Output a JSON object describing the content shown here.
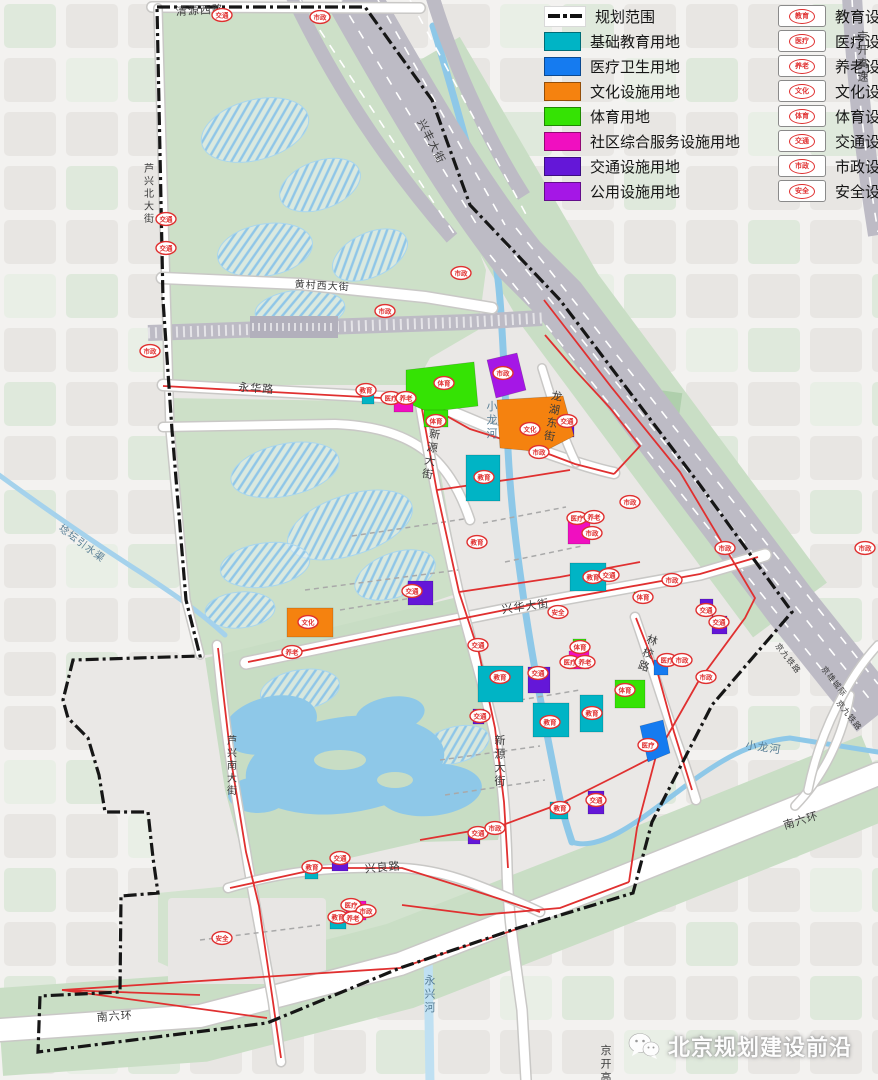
{
  "colors": {
    "education": "#00B4C5",
    "medical": "#157BF0",
    "culture": "#F5820F",
    "sports": "#35E304",
    "community": "#F00FC0",
    "transport": "#6417D8",
    "public": "#A517E6",
    "marker": "#E03030",
    "planning_red": "#E03030",
    "boundary": "#161616",
    "water": "#8EC8E8",
    "park": "#CDE0C8",
    "rail": "#BDBBC5"
  },
  "legend": {
    "land_use": [
      {
        "label": "规划范围",
        "type": "line"
      },
      {
        "label": "基础教育用地",
        "color": "education"
      },
      {
        "label": "医疗卫生用地",
        "color": "medical"
      },
      {
        "label": "文化设施用地",
        "color": "culture"
      },
      {
        "label": "体育用地",
        "color": "sports"
      },
      {
        "label": "社区综合服务设施用地",
        "color": "community"
      },
      {
        "label": "交通设施用地",
        "color": "transport"
      },
      {
        "label": "公用设施用地",
        "color": "public"
      }
    ],
    "facilities": [
      {
        "icon": "教育",
        "label": "教育设施"
      },
      {
        "icon": "医疗",
        "label": "医疗设施"
      },
      {
        "icon": "养老",
        "label": "养老设施"
      },
      {
        "icon": "文化",
        "label": "文化设施"
      },
      {
        "icon": "体育",
        "label": "体育设施"
      },
      {
        "icon": "交通",
        "label": "交通设施"
      },
      {
        "icon": "市政",
        "label": "市政设施"
      },
      {
        "icon": "安全",
        "label": "安全设施"
      }
    ]
  },
  "road_labels": [
    {
      "text": "清源西路",
      "x": 200,
      "y": 14,
      "rotate": -3
    },
    {
      "text": "芦兴北大街",
      "x": 149,
      "y": 172,
      "vertical": true
    },
    {
      "text": "黄村西大街",
      "x": 322,
      "y": 289,
      "rotate": 3
    },
    {
      "text": "永华路",
      "x": 256,
      "y": 392,
      "rotate": 4
    },
    {
      "text": "兴丰大街",
      "x": 428,
      "y": 143,
      "rotate": 63
    },
    {
      "text": "新源大街",
      "x": 434,
      "y": 438,
      "vertical": true,
      "rotate": 10
    },
    {
      "text": "新源大街",
      "x": 500,
      "y": 744,
      "vertical": true
    },
    {
      "text": "兴华大街",
      "x": 526,
      "y": 610,
      "rotate": -8
    },
    {
      "text": "林校路",
      "x": 651,
      "y": 644,
      "vertical": true,
      "rotate": 18
    },
    {
      "text": "龙湖东街",
      "x": 556,
      "y": 400,
      "vertical": true,
      "rotate": 10
    },
    {
      "text": "芦兴南大街",
      "x": 232,
      "y": 744,
      "vertical": true
    },
    {
      "text": "兴良路",
      "x": 383,
      "y": 871,
      "rotate": -5
    },
    {
      "text": "南六环",
      "x": 115,
      "y": 1020,
      "rotate": -4
    },
    {
      "text": "南六环",
      "x": 802,
      "y": 824,
      "rotate": -17
    },
    {
      "text": "京开高速",
      "x": 863,
      "y": 40,
      "vertical": true
    },
    {
      "text": "京开高速",
      "x": 606,
      "y": 1054,
      "vertical": true
    },
    {
      "text": "京九铁路",
      "x": 786,
      "y": 660,
      "rotate": 52,
      "small": true
    },
    {
      "text": "京雄城际",
      "x": 832,
      "y": 683,
      "rotate": 52,
      "small": true
    },
    {
      "text": "京九铁路",
      "x": 847,
      "y": 717,
      "rotate": 52,
      "small": true
    }
  ],
  "water_labels": [
    {
      "text": "小龙河",
      "x": 492,
      "y": 410,
      "vertical": true
    },
    {
      "text": "小龙河",
      "x": 763,
      "y": 751,
      "rotate": 8
    },
    {
      "text": "永兴河",
      "x": 430,
      "y": 984,
      "vertical": true
    },
    {
      "text": "埝坛引水渠",
      "x": 80,
      "y": 546,
      "rotate": 37
    }
  ],
  "markers": [
    {
      "t": "交通",
      "x": 222,
      "y": 15
    },
    {
      "t": "市政",
      "x": 320,
      "y": 17
    },
    {
      "t": "交通",
      "x": 166,
      "y": 219
    },
    {
      "t": "交通",
      "x": 166,
      "y": 248
    },
    {
      "t": "市政",
      "x": 150,
      "y": 351
    },
    {
      "t": "市政",
      "x": 385,
      "y": 311
    },
    {
      "t": "市政",
      "x": 461,
      "y": 273
    },
    {
      "t": "教育",
      "x": 366,
      "y": 390
    },
    {
      "t": "医疗",
      "x": 391,
      "y": 398
    },
    {
      "t": "养老",
      "x": 406,
      "y": 398
    },
    {
      "t": "体育",
      "x": 436,
      "y": 421
    },
    {
      "t": "体育",
      "x": 444,
      "y": 383
    },
    {
      "t": "市政",
      "x": 503,
      "y": 373
    },
    {
      "t": "文化",
      "x": 530,
      "y": 429
    },
    {
      "t": "交通",
      "x": 567,
      "y": 421
    },
    {
      "t": "市政",
      "x": 539,
      "y": 452
    },
    {
      "t": "教育",
      "x": 484,
      "y": 477
    },
    {
      "t": "教育",
      "x": 477,
      "y": 542
    },
    {
      "t": "医疗",
      "x": 577,
      "y": 518
    },
    {
      "t": "养老",
      "x": 594,
      "y": 517
    },
    {
      "t": "市政",
      "x": 592,
      "y": 533
    },
    {
      "t": "市政",
      "x": 630,
      "y": 502
    },
    {
      "t": "市政",
      "x": 725,
      "y": 548
    },
    {
      "t": "市政",
      "x": 865,
      "y": 548
    },
    {
      "t": "教育",
      "x": 593,
      "y": 577
    },
    {
      "t": "交通",
      "x": 609,
      "y": 575
    },
    {
      "t": "市政",
      "x": 672,
      "y": 580
    },
    {
      "t": "体育",
      "x": 643,
      "y": 597
    },
    {
      "t": "交通",
      "x": 412,
      "y": 591
    },
    {
      "t": "文化",
      "x": 308,
      "y": 622
    },
    {
      "t": "养老",
      "x": 292,
      "y": 652
    },
    {
      "t": "安全",
      "x": 558,
      "y": 612
    },
    {
      "t": "交通",
      "x": 706,
      "y": 610
    },
    {
      "t": "交通",
      "x": 719,
      "y": 622
    },
    {
      "t": "交通",
      "x": 478,
      "y": 645
    },
    {
      "t": "体育",
      "x": 580,
      "y": 647
    },
    {
      "t": "医疗",
      "x": 570,
      "y": 662
    },
    {
      "t": "养老",
      "x": 585,
      "y": 662
    },
    {
      "t": "医疗",
      "x": 667,
      "y": 660
    },
    {
      "t": "市政",
      "x": 682,
      "y": 660
    },
    {
      "t": "教育",
      "x": 500,
      "y": 677
    },
    {
      "t": "交通",
      "x": 538,
      "y": 673
    },
    {
      "t": "市政",
      "x": 706,
      "y": 677
    },
    {
      "t": "体育",
      "x": 625,
      "y": 690
    },
    {
      "t": "交通",
      "x": 480,
      "y": 716
    },
    {
      "t": "教育",
      "x": 550,
      "y": 722
    },
    {
      "t": "教育",
      "x": 592,
      "y": 713
    },
    {
      "t": "医疗",
      "x": 648,
      "y": 745
    },
    {
      "t": "教育",
      "x": 560,
      "y": 808
    },
    {
      "t": "交通",
      "x": 596,
      "y": 800
    },
    {
      "t": "交通",
      "x": 478,
      "y": 833
    },
    {
      "t": "市政",
      "x": 495,
      "y": 828
    },
    {
      "t": "教育",
      "x": 312,
      "y": 867
    },
    {
      "t": "交通",
      "x": 340,
      "y": 858
    },
    {
      "t": "医疗",
      "x": 351,
      "y": 905
    },
    {
      "t": "市政",
      "x": 366,
      "y": 911
    },
    {
      "t": "教育",
      "x": 338,
      "y": 917
    },
    {
      "t": "养老",
      "x": 353,
      "y": 918
    },
    {
      "t": "安全",
      "x": 222,
      "y": 938
    }
  ],
  "watermark": {
    "text": "北京规划建设前沿"
  }
}
